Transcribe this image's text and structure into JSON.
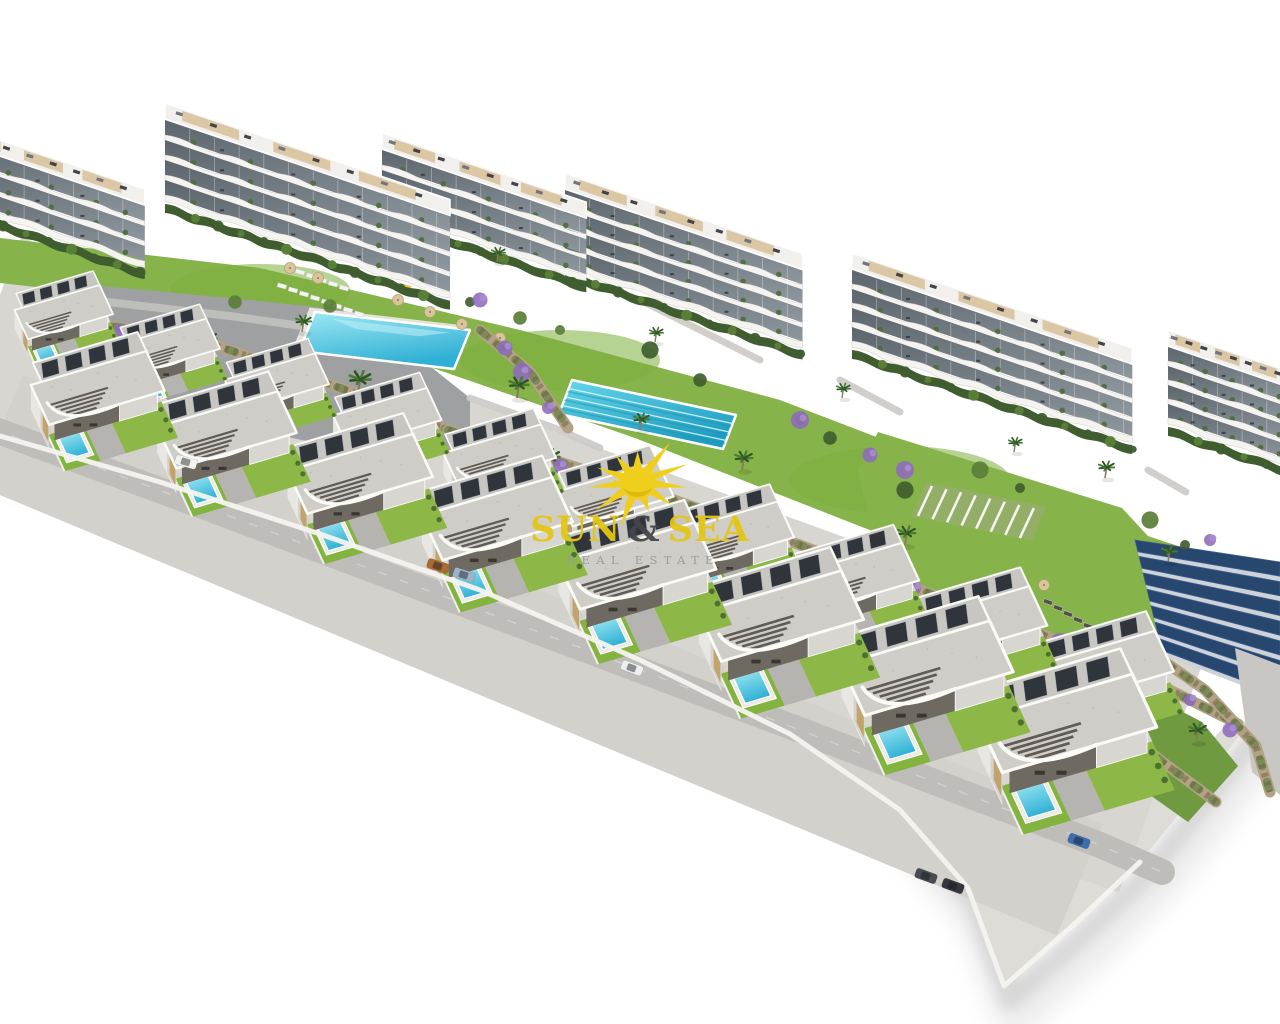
{
  "image_type": "aerial 3D architectural render of a coastal residential development with apartment blocks, pool amenities and villa rows",
  "watermark": {
    "word1": "SUN",
    "amp": "&",
    "word2": "SEA",
    "subtitle": "REAL ESTATE",
    "icon": "sun-rays-icon",
    "colors": {
      "text": "#e4c614",
      "amp": "#45464b",
      "subtitle": "#969c9d",
      "sun": "#f0ce1c",
      "sun_shade": "#dcb80e"
    }
  },
  "palette": {
    "bg": "#ffffff",
    "lawn": "#87b44a",
    "lawn2": "#7cae3d",
    "plaza": "#9fa0a2",
    "road": "#bfbdba",
    "base": "#d8d6d1",
    "podium": "#dedcd7",
    "rim": "#f4f3f0",
    "shadow1": "#c6c6c6",
    "shadow2": "#dadada",
    "roof": "#cfcdc7",
    "roof_rear": "#c8c6c0",
    "panel": "#2f353b",
    "panel_edge": "#aeb6bd",
    "wall": "#e9e7e3",
    "wall_shade": "#d6d3cd",
    "tan": "#c2a36e",
    "terrace_dark": "#6e6961",
    "deck": "#d8d6d1",
    "fascia": "#fafaf7",
    "slat": "#4c4740",
    "pool_hi": "#9fe9f4",
    "pool_lo": "#2fb0d4",
    "pool_deck": "#eceae5",
    "lap_hi": "#66d6e9",
    "lap_lo": "#1f9dc0",
    "lane": "#d9f4f9",
    "window_hi": "#8f979e",
    "window_lo": "#5d656d",
    "slab": "#f5f4f1",
    "slab_edge": "#cfcdc8",
    "rooftop": "#f1f0ed",
    "roof_tan": "#d7c096",
    "roof_item": "#41454a",
    "hedge": "#3f5d2e",
    "bush": "#5a7f38",
    "plant": "#4d6b3c",
    "stone": "#b3a285",
    "stone_dark": "#857457",
    "green_over": "#4c7030",
    "purple": "#8e6bbd",
    "purple_lt": "#a98fd0",
    "palm_dark": "#2f5526",
    "palm_lt": "#4a7a33",
    "trunk": "#8a7a5c",
    "solar": "#27476e",
    "solar_lt": "#3b5f94",
    "solar_frame": "#cfd3d8",
    "sand": "#e3d6b4",
    "lounger": "#f4f4f2",
    "lounger_dk": "#55504a",
    "umbrella": "#d9c49c",
    "umbrella_dk": "#8d7a55",
    "green_wedge": "#6f9a3f",
    "person": "#3c3c40"
  },
  "scene": {
    "apartments": [
      [
        1168,
        345,
        130,
        4,
        19
      ],
      [
        852,
        268,
        295,
        4,
        19
      ],
      [
        565,
        188,
        250,
        4,
        19
      ],
      [
        382,
        148,
        215,
        3,
        20
      ],
      [
        165,
        118,
        300,
        4,
        20
      ],
      [
        -50,
        138,
        205,
        3,
        20
      ]
    ],
    "villas_axes": {
      "u": [
        0.95,
        -0.28
      ],
      "v": [
        0.42,
        0.91
      ]
    },
    "villas_back": [
      [
        8,
        296,
        0.7
      ],
      [
        112,
        330,
        0.72
      ],
      [
        218,
        365,
        0.74
      ],
      [
        326,
        400,
        0.77
      ],
      [
        436,
        437,
        0.8
      ],
      [
        549,
        475,
        0.83
      ],
      [
        665,
        515,
        0.86
      ],
      [
        784,
        557,
        0.9
      ],
      [
        906,
        601,
        0.94
      ],
      [
        1028,
        646,
        0.97
      ]
    ],
    "villas_front": [
      [
        22,
        366,
        0.95
      ],
      [
        148,
        407,
        0.99
      ],
      [
        278,
        450,
        1.03
      ],
      [
        412,
        494,
        1.07
      ],
      [
        548,
        540,
        1.12
      ],
      [
        688,
        589,
        1.17
      ],
      [
        830,
        640,
        1.22
      ],
      [
        966,
        694,
        1.27
      ]
    ],
    "lawn_band": [
      [
        0,
        238
      ],
      [
        260,
        268
      ],
      [
        520,
        330
      ],
      [
        780,
        400
      ],
      [
        1040,
        500
      ],
      [
        1280,
        580
      ],
      [
        1280,
        665
      ],
      [
        1150,
        640
      ],
      [
        890,
        538
      ],
      [
        635,
        438
      ],
      [
        375,
        348
      ],
      [
        135,
        298
      ],
      [
        0,
        283
      ]
    ],
    "plaza": [
      [
        60,
        282
      ],
      [
        250,
        300
      ],
      [
        362,
        312
      ],
      [
        470,
        398
      ],
      [
        470,
        452
      ],
      [
        358,
        452
      ],
      [
        198,
        418
      ],
      [
        78,
        346
      ]
    ],
    "pool_main": [
      [
        315,
        312
      ],
      [
        470,
        330
      ],
      [
        454,
        369
      ],
      [
        299,
        351
      ]
    ],
    "pool_lap": [
      [
        572,
        380
      ],
      [
        736,
        415
      ],
      [
        723,
        449
      ],
      [
        559,
        414
      ]
    ],
    "right_lawn": [
      [
        878,
        432
      ],
      [
        1122,
        508
      ],
      [
        1172,
        562
      ],
      [
        1158,
        652
      ],
      [
        1048,
        722
      ],
      [
        938,
        680
      ],
      [
        878,
        560
      ],
      [
        858,
        470
      ]
    ],
    "green_wedge": [
      [
        1118,
        678
      ],
      [
        1202,
        722
      ],
      [
        1238,
        766
      ],
      [
        1188,
        822
      ],
      [
        1126,
        778
      ],
      [
        1092,
        720
      ]
    ],
    "sand": [
      [
        1012,
        625
      ],
      [
        1098,
        652
      ],
      [
        1082,
        712
      ],
      [
        1000,
        682
      ]
    ],
    "solar_field": {
      "quad": [
        [
          1135,
          540
        ],
        [
          1280,
          562
        ],
        [
          1280,
          700
        ],
        [
          1163,
          655
        ]
      ],
      "bars": 7
    },
    "walls": [
      [
        [
          48,
          316
        ],
        [
          200,
          340
        ],
        [
          352,
          392
        ],
        [
          448,
          430
        ]
      ],
      [
        [
          448,
          430
        ],
        [
          560,
          462
        ],
        [
          680,
          502
        ],
        [
          800,
          545
        ],
        [
          920,
          590
        ],
        [
          1046,
          636
        ],
        [
          1160,
          685
        ],
        [
          1238,
          724
        ]
      ],
      [
        [
          1128,
          636
        ],
        [
          1205,
          690
        ],
        [
          1256,
          746
        ],
        [
          1270,
          792
        ]
      ],
      [
        [
          1085,
          700
        ],
        [
          1160,
          760
        ],
        [
          1216,
          802
        ]
      ],
      [
        [
          480,
          330
        ],
        [
          530,
          372
        ],
        [
          568,
          428
        ]
      ]
    ],
    "roads": {
      "rb": [
        [
          -10,
          428
        ],
        [
          200,
          505
        ],
        [
          400,
          580
        ],
        [
          600,
          655
        ],
        [
          800,
          730
        ],
        [
          950,
          788
        ],
        [
          1100,
          845
        ],
        [
          1162,
          872
        ]
      ],
      "right_quad": [
        [
          1235,
          648
        ],
        [
          1280,
          665
        ],
        [
          1280,
          795
        ],
        [
          1252,
          772
        ]
      ],
      "paths": [
        [
          [
            470,
            398
          ],
          [
            560,
            430
          ],
          [
            600,
            448
          ]
        ],
        [
          [
            640,
            300
          ],
          [
            700,
            330
          ],
          [
            760,
            360
          ]
        ],
        [
          [
            840,
            380
          ],
          [
            900,
            412
          ]
        ],
        [
          [
            1148,
            470
          ],
          [
            1186,
            492
          ]
        ]
      ]
    },
    "podium_outer": [
      [
        0,
        436
      ],
      [
        160,
        482
      ],
      [
        320,
        534
      ],
      [
        480,
        590
      ],
      [
        640,
        660
      ],
      [
        790,
        734
      ],
      [
        900,
        810
      ],
      [
        968,
        888
      ],
      [
        1004,
        986
      ],
      [
        1070,
        928
      ],
      [
        1140,
        862
      ],
      [
        1200,
        788
      ],
      [
        1248,
        724
      ]
    ],
    "podium_inner": [
      [
        1236,
        716
      ],
      [
        1160,
        790
      ],
      [
        1100,
        856
      ],
      [
        1040,
        916
      ],
      [
        1000,
        838
      ],
      [
        930,
        768
      ],
      [
        840,
        708
      ],
      [
        720,
        648
      ],
      [
        580,
        593
      ],
      [
        400,
        533
      ],
      [
        200,
        468
      ],
      [
        0,
        406
      ]
    ],
    "edge_rim": [
      [
        0,
        436
      ],
      [
        160,
        482
      ],
      [
        320,
        534
      ],
      [
        480,
        590
      ],
      [
        640,
        660
      ],
      [
        790,
        734
      ],
      [
        900,
        810
      ],
      [
        968,
        888
      ],
      [
        1004,
        986
      ],
      [
        1070,
        928
      ],
      [
        1140,
        862
      ]
    ],
    "palms": [
      [
        205,
        352,
        1
      ],
      [
        358,
        394,
        1.1
      ],
      [
        302,
        332,
        0.8
      ],
      [
        517,
        398,
        1
      ],
      [
        548,
        470,
        1
      ],
      [
        640,
        430,
        0.8
      ],
      [
        742,
        470,
        0.9
      ],
      [
        905,
        545,
        0.9
      ],
      [
        1105,
        478,
        0.8
      ],
      [
        1168,
        562,
        0.8
      ],
      [
        1065,
        788,
        1
      ],
      [
        1196,
        742,
        0.9
      ],
      [
        497,
        262,
        0.7
      ],
      [
        655,
        342,
        0.7
      ],
      [
        842,
        398,
        0.7
      ],
      [
        1014,
        452,
        0.7
      ]
    ],
    "flowers": [
      [
        120,
        330
      ],
      [
        152,
        346
      ],
      [
        188,
        360
      ],
      [
        240,
        372
      ],
      [
        300,
        388
      ],
      [
        365,
        408
      ],
      [
        455,
        436
      ],
      [
        560,
        466
      ],
      [
        628,
        489
      ],
      [
        700,
        512
      ],
      [
        770,
        536
      ],
      [
        845,
        562
      ],
      [
        915,
        588
      ],
      [
        988,
        614
      ],
      [
        1060,
        642
      ],
      [
        1128,
        668
      ],
      [
        505,
        348
      ],
      [
        522,
        372
      ],
      [
        548,
        408
      ],
      [
        870,
        455
      ],
      [
        905,
        470
      ],
      [
        1190,
        700
      ],
      [
        1230,
        730
      ],
      [
        100,
        318
      ],
      [
        1155,
        688
      ],
      [
        480,
        300
      ],
      [
        800,
        420
      ],
      [
        1210,
        540
      ]
    ],
    "bushes": [
      [
        470,
        302
      ],
      [
        520,
        318
      ],
      [
        650,
        350
      ],
      [
        800,
        420
      ],
      [
        830,
        438
      ],
      [
        1150,
        520
      ],
      [
        1185,
        545
      ],
      [
        235,
        302
      ],
      [
        90,
        300
      ],
      [
        560,
        330
      ],
      [
        700,
        380
      ],
      [
        980,
        470
      ],
      [
        1020,
        488
      ],
      [
        330,
        306
      ],
      [
        905,
        490
      ]
    ],
    "cars": [
      [
        186,
        462,
        16,
        "#f2f2f0"
      ],
      [
        438,
        566,
        18,
        "#a96a33"
      ],
      [
        464,
        575,
        18,
        "#9db4c6"
      ],
      [
        632,
        668,
        20,
        "#eceff1"
      ],
      [
        926,
        876,
        20,
        "#474b52"
      ],
      [
        953,
        886,
        20,
        "#34383d"
      ],
      [
        1079,
        841,
        20,
        "#3d6dae"
      ]
    ],
    "loungers_white": {
      "start": [
        282,
        286
      ],
      "step": [
        11,
        4
      ],
      "count": 8,
      "rot": 15
    },
    "loungers_white2": {
      "start": [
        300,
        272
      ],
      "step": [
        11,
        4
      ],
      "count": 5,
      "rot": 15
    },
    "loungers_dark": {
      "start": [
        1048,
        602
      ],
      "step": [
        10,
        6
      ],
      "count": 6,
      "rot": 20
    },
    "umbrellas": [
      [
        398,
        300
      ],
      [
        430,
        312
      ],
      [
        462,
        324
      ],
      [
        500,
        338
      ],
      [
        290,
        268
      ],
      [
        318,
        278
      ],
      [
        1044,
        585
      ]
    ],
    "pergola": {
      "start": [
        932,
        486
      ],
      "dir": [
        0.97,
        0.21
      ],
      "count": 8,
      "len": 30
    },
    "playground": [
      [
        388,
        282,
        "#d98a2a"
      ],
      [
        406,
        288,
        "#e8c33c"
      ],
      [
        424,
        295,
        "#c65545"
      ],
      [
        440,
        301,
        "#4a86c8"
      ]
    ],
    "people": [
      [
        452,
        440
      ],
      [
        470,
        452
      ]
    ],
    "lap_lanes": 3
  }
}
